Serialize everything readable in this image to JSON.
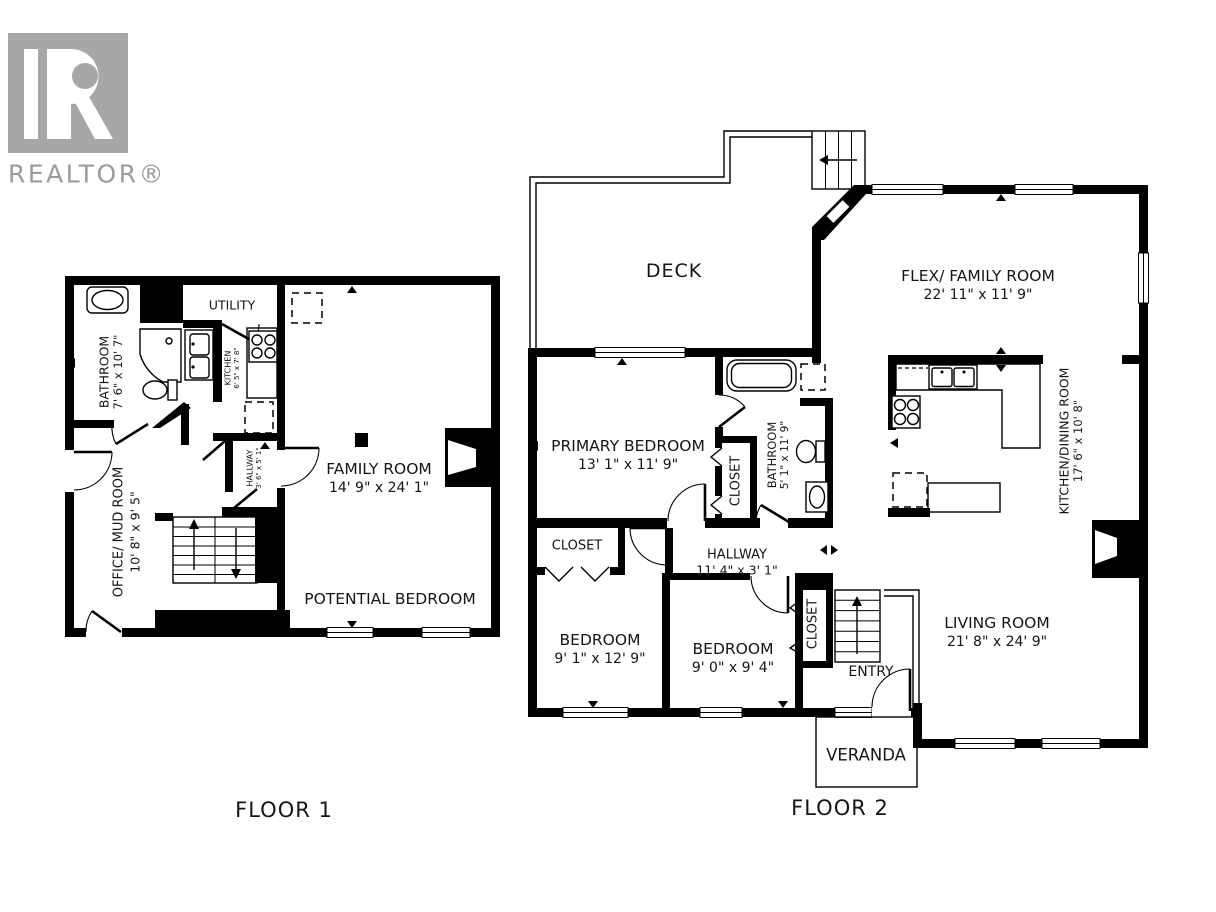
{
  "colors": {
    "wall": "#000000",
    "logo_gray": "#a7a7a7",
    "logo_text_gray": "#9b9b9b",
    "background": "#ffffff",
    "text": "#151515"
  },
  "logo": {
    "brand": "REALTOR®"
  },
  "floor1": {
    "caption": "FLOOR 1",
    "rooms": {
      "bathroom": {
        "name": "BATHROOM",
        "dims": "7' 6\" x 10' 7\""
      },
      "utility": {
        "name": "UTILITY"
      },
      "kitchen": {
        "name": "KITCHEN",
        "dims": "6' 5\" x 7' 8\""
      },
      "hallway": {
        "name": "HALLWAY",
        "dims": "3' 6\" x 5' 1\""
      },
      "office_mud_room": {
        "name": "OFFICE/ MUD ROOM",
        "dims": "10' 8\" x 9' 5\""
      },
      "family_room": {
        "name": "FAMILY ROOM",
        "dims": "14' 9\" x 24' 1\""
      },
      "potential_bedroom": {
        "name": "POTENTIAL BEDROOM"
      }
    }
  },
  "floor2": {
    "caption": "FLOOR 2",
    "rooms": {
      "deck": {
        "name": "DECK"
      },
      "flex_family_room": {
        "name": "FLEX/ FAMILY ROOM",
        "dims": "22' 11\" x 11' 9\""
      },
      "kitchen_dining": {
        "name": "KITCHEN/DINING ROOM",
        "dims": "17' 6\" x 10' 8\""
      },
      "primary_bedroom": {
        "name": "PRIMARY BEDROOM",
        "dims": "13' 1\" x 11' 9\""
      },
      "primary_closet": {
        "name": "CLOSET"
      },
      "bathroom": {
        "name": "BATHROOM",
        "dims": "5' 1\" x 11' 9\""
      },
      "hall_closet": {
        "name": "CLOSET"
      },
      "hallway": {
        "name": "HALLWAY",
        "dims": "11' 4\" x 3' 1\""
      },
      "bedroom_left": {
        "name": "BEDROOM",
        "dims": "9' 1\" x 12' 9\""
      },
      "bedroom_right": {
        "name": "BEDROOM",
        "dims": "9' 0\" x 9' 4\""
      },
      "entry_closet": {
        "name": "CLOSET"
      },
      "entry": {
        "name": "ENTRY"
      },
      "living_room": {
        "name": "LIVING ROOM",
        "dims": "21' 8\" x 24' 9\""
      },
      "veranda": {
        "name": "VERANDA"
      }
    }
  }
}
